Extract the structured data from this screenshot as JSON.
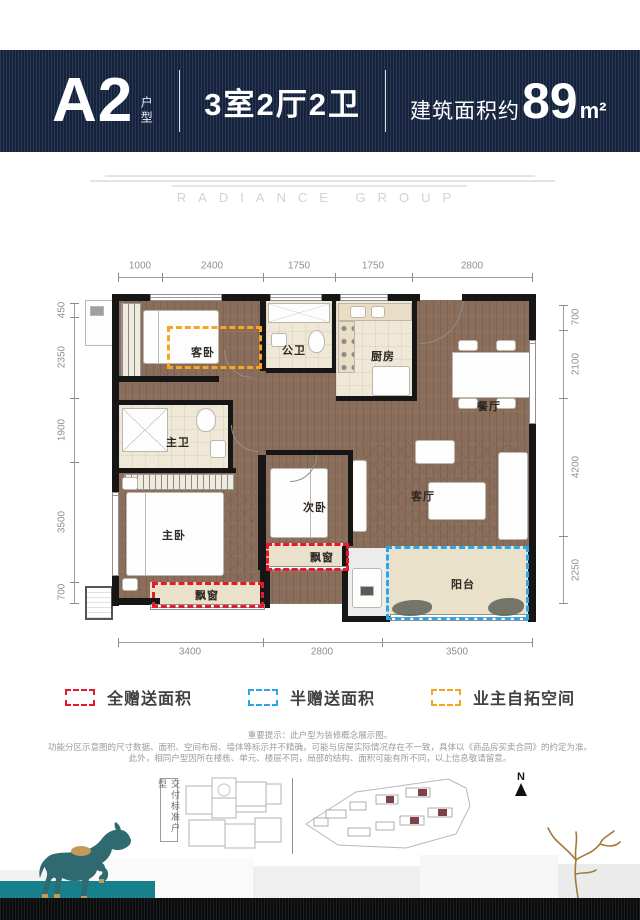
{
  "header": {
    "unit_code": "A2",
    "unit_suffix": "户型",
    "rooms_summary": "3室2厅2卫",
    "area_prefix": "建筑面积约",
    "area_value": "89",
    "area_unit": "m²"
  },
  "watermark": {
    "brand": "RADIANCE GROUP"
  },
  "floorplan": {
    "dims_top": [
      "1000",
      "2400",
      "1750",
      "1750",
      "2800"
    ],
    "dims_left": [
      "450",
      "2350",
      "1900",
      "3500",
      "700"
    ],
    "dims_right": [
      "700",
      "2100",
      "4200",
      "2250"
    ],
    "dims_bottom": [
      "3400",
      "2800",
      "3500"
    ],
    "rooms": {
      "guest_bedroom": "客卧",
      "public_bath": "公卫",
      "kitchen": "厨房",
      "dining": "餐厅",
      "master_bath": "主卫",
      "master_bedroom": "主卧",
      "second_bedroom": "次卧",
      "living": "客厅",
      "bay_window_master": "飘窗",
      "bay_window_second": "飘窗",
      "balcony": "阳台"
    }
  },
  "legend": {
    "items": [
      {
        "label": "全赠送面积",
        "color": "#e8192c"
      },
      {
        "label": "半赠送面积",
        "color": "#2aa7e8"
      },
      {
        "label": "业主自拓空间",
        "color": "#f5a623"
      }
    ]
  },
  "disclaimer": {
    "line1": "重要提示：此户型为装修概念展示图。",
    "line2": "功能分区示意图的尺寸数据、面积、空间布局、墙体等标示并不精确，可能与房屋实际情况存在不一致，具体以《商品房买卖合同》的约定为准。",
    "line3": "此外，相同户型因所在楼栋、单元、楼层不同，局部的结构、面积可能有所不同，以上信息敬请留意。"
  },
  "footer": {
    "delivery_label": "交付标准户型",
    "compass_label": "N"
  }
}
